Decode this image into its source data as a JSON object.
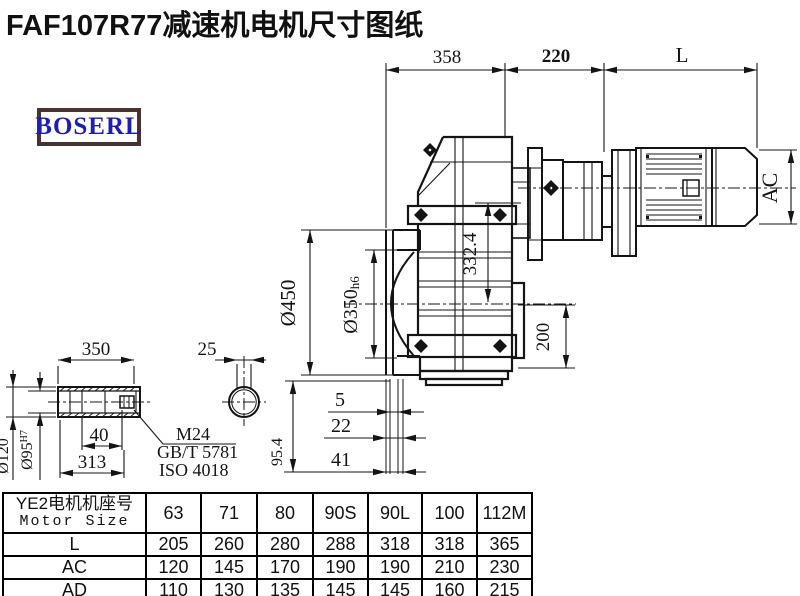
{
  "title": "FAF107R77减速机电机尺寸图纸",
  "logo": {
    "text": "BOSERL"
  },
  "drawing": {
    "dims": {
      "d358": "358",
      "d220": "220",
      "dL": "L",
      "d450": "Ø450",
      "d350": "Ø350",
      "d350tol": "h6",
      "d332": "332.4",
      "d200": "200",
      "dAC": "AC",
      "d5": "5",
      "d22": "22",
      "d41": "41",
      "d954": "95.4",
      "shaft350": "350",
      "d25": "25",
      "d40": "40",
      "d313": "313",
      "d120": "Ø120",
      "d95": "Ø95",
      "d95tol": "H7",
      "m24": "M24",
      "gbt": "GB/T 5781",
      "iso": "ISO 4018"
    }
  },
  "table": {
    "header_cn": "YE2电机机座号",
    "header_en": "Motor Size",
    "columns": [
      "63",
      "71",
      "80",
      "90S",
      "90L",
      "100",
      "112M"
    ],
    "rows": [
      {
        "label": "L",
        "values": [
          "205",
          "260",
          "280",
          "288",
          "318",
          "318",
          "365"
        ]
      },
      {
        "label": "AC",
        "values": [
          "120",
          "145",
          "170",
          "190",
          "190",
          "210",
          "230"
        ]
      },
      {
        "label": "AD",
        "values": [
          "110",
          "130",
          "135",
          "145",
          "145",
          "160",
          "215"
        ]
      }
    ]
  },
  "colors": {
    "line": "#141414",
    "logo_text": "#1e1eb0",
    "logo_border": "#4a3232"
  }
}
